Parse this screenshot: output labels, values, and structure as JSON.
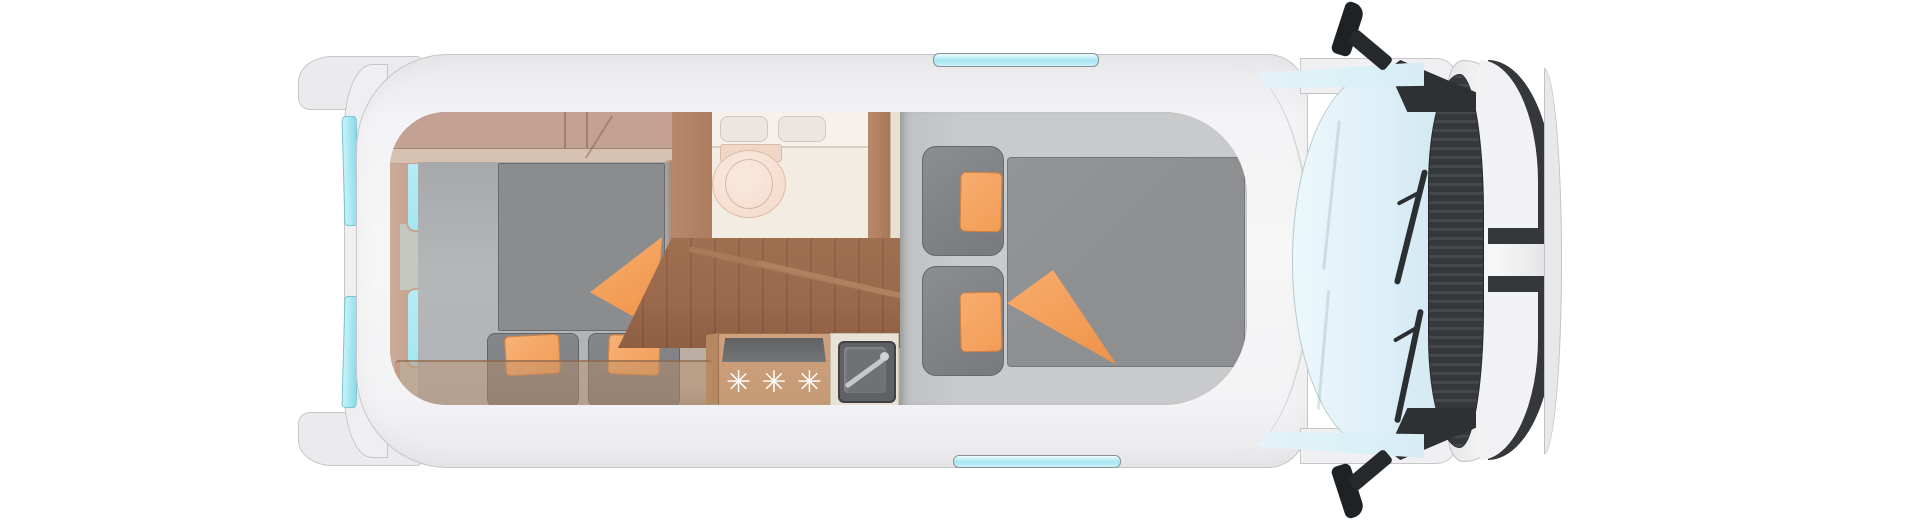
{
  "scene": {
    "title": "Campervan floor plan, top view",
    "type": "vehicle-floorplan-top-view",
    "background": "#ffffff"
  },
  "colors": {
    "body": "#f6f6f7",
    "body_edge": "#c6c6c9",
    "glass_cyan": "#a5e6f2",
    "windshield": "#dff0f8",
    "black_trim": "#35383b",
    "wall_tan": "#baaea5",
    "wall_tan_dark": "#c3a294",
    "wood_dark": "#b9886a",
    "wood_floor": "#9a684b",
    "wood_counter": "#c49a74",
    "floor_gray": "#b4b6b8",
    "mat_gray": "#8a8c8e",
    "cushion_gray": "#77797c",
    "platform_gray": "#c8cacc",
    "duvet_gray": "#8d8f91",
    "orange": "#f29d57",
    "bath_floor": "#f3ece3",
    "vanity": "#f6f1ea",
    "toilet": "#f2d8c9",
    "sink_dark": "#5f6163"
  },
  "vehicle": {
    "orientation": "cab on right, rear doors on left",
    "exterior": {
      "rear_door_window_strips": 2,
      "roof_vents": 2,
      "cab_side_windows": 2,
      "windshield_count": 1,
      "side_mirrors": 2
    }
  },
  "lounge": {
    "rear_interior_windows": 2,
    "bench_seats": 2,
    "orange_accent_pillows": 2,
    "orange_throw_blanket": 1,
    "dark_mat": 1,
    "translucent_table": 1,
    "overhead_cabinet": 1
  },
  "bathroom": {
    "toilet_count": 1,
    "washbasin_bowls": 2
  },
  "kitchen": {
    "burner_symbol": "✳",
    "burner_count": 3,
    "sink_count": 1,
    "faucet_count": 1
  },
  "bed": {
    "gray_pillows": 2,
    "orange_pillows": 2,
    "duvet_count": 1,
    "orange_blanket_fold": 1
  }
}
